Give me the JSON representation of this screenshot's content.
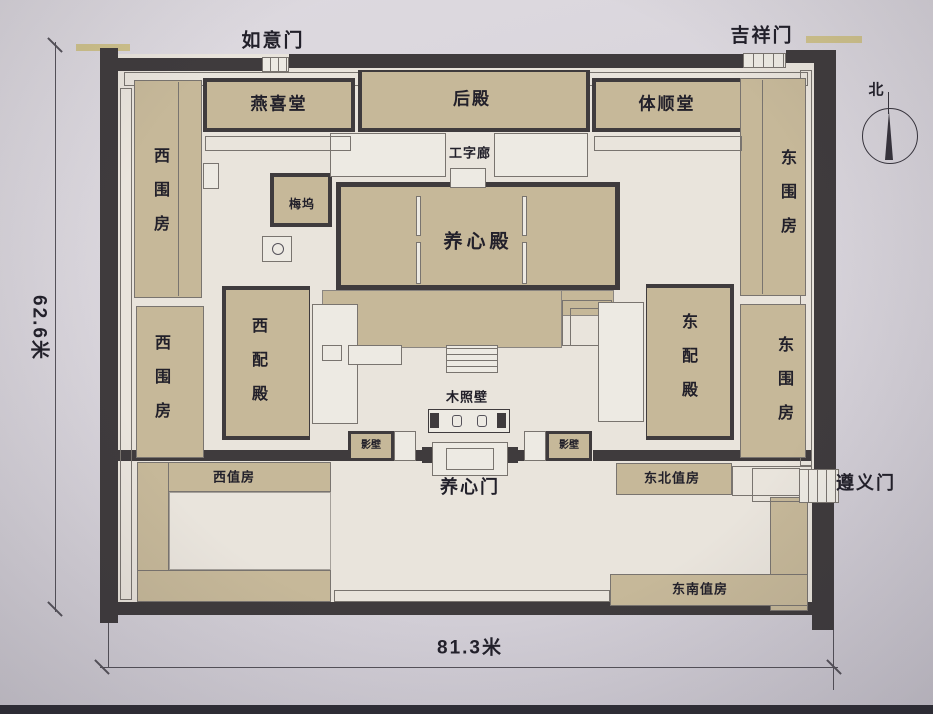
{
  "plan": {
    "gates": {
      "ruyimen": "如意门",
      "jixiangmen": "吉祥门",
      "zunyimen": "遵义门",
      "yangxinmen": "养心门"
    },
    "halls": {
      "yanxitang": "燕喜堂",
      "houdian": "后殿",
      "tishuntang": "体顺堂",
      "gongzilang": "工字廊",
      "meiwu": "梅坞",
      "yangxindian": "养心殿",
      "xipeidian": "西配殿",
      "dongpeidian": "东配殿",
      "xiweifang": "西围房",
      "dongweifang": "东围房",
      "muzhaobi": "木照壁",
      "yingbi": "影壁",
      "xizhifang": "西值房",
      "dongbeizhifang": "东北值房",
      "dongnanzhifang": "东南值房"
    },
    "dimensions": {
      "height": "62.6米",
      "width": "81.3米"
    },
    "compass": {
      "north": "北"
    },
    "icons": {
      "compass_needle": "north-arrow-triangle"
    },
    "colors": {
      "paper": "#d7d3da",
      "courtyard": "#e9e4dc",
      "building": "#c6b899",
      "wall": "#3f3b3d",
      "gate_accent": "#cfc28c",
      "ink": "#22202a"
    }
  }
}
